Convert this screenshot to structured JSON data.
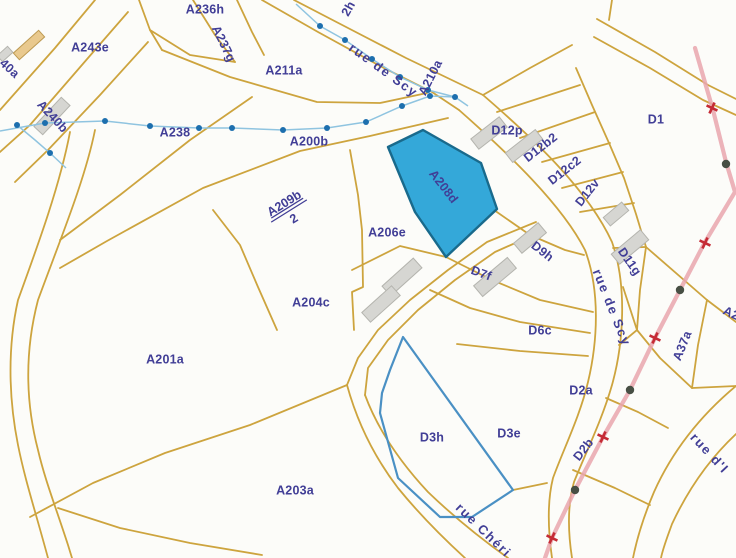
{
  "colors": {
    "background": "#fcfcf9",
    "parcel_line": "#cda43e",
    "label": "#413e96",
    "selected_fill": "#29a3d7",
    "selected_stroke": "#196a8c",
    "outlined_stroke": "#4a90c4",
    "stream_line": "#8fc4e0",
    "stream_dot": "#1d6fae",
    "boundary_line": "#e9a6ae",
    "boundary_cross": "#c52b35",
    "boundary_dot": "#474f44",
    "building_gray": "#d6d6d2",
    "building_gray_stroke": "#b4b4ae",
    "building_tan": "#e9c98e",
    "building_tan_stroke": "#bd9a52"
  },
  "map": {
    "width": 736,
    "height": 558,
    "selected_parcel": {
      "id": "A208d",
      "points": "423,130 481,163 497,209 446,257 415,212 388,147"
    },
    "outlined_parcel": {
      "id": "D3h",
      "points": "403,337 513,490 472,517 440,517 398,478 380,413 382,393 390,370"
    },
    "lines": [
      "M262,0 L318,32 L380,66 L432,92 L459,110",
      "M294,0 L348,28 L406,58 L458,83 L483,95",
      "M459,110 C510,155 562,205 585,250 C600,290 598,340 588,382 C580,416 564,448 553,478 C547,502 548,530 552,558",
      "M483,95 C535,140 588,190 612,242 C627,285 624,342 612,385 C602,420 586,452 574,482 C567,506 568,532 572,558",
      "M347,385 C358,425 375,458 398,488 C420,515 442,537 465,558",
      "M365,395 C378,430 400,462 428,492 C455,518 480,538 508,558",
      "M536,222 L487,242 L448,270 L410,300 L378,330 L358,358 L347,385",
      "M540,232 L495,252 L455,280 L418,310 L388,340 L368,368 L365,395",
      "M736,386 C700,416 672,452 654,492 C643,518 637,538 633,558",
      "M736,434 C706,462 686,494 672,524 C667,538 663,548 661,558",
      "M597,19 L655,52 L708,85 L736,99",
      "M594,37 L650,68 L703,100 L736,115",
      "M612,0 L609,20",
      "M483,95 L530,68 L572,45",
      "M576,68 L592,105 L609,143 L624,178 L636,214 L646,247",
      "M497,112 L580,85",
      "M520,138 L595,112",
      "M542,162 L610,143",
      "M562,188 L623,172",
      "M580,212 L634,203",
      "M613,248 L646,247",
      "M646,247 L707,300",
      "M646,247 L640,290 L637,330",
      "M707,300 L698,345 L692,388",
      "M637,330 L660,358 L692,388",
      "M707,300 L736,322",
      "M623,287 L637,330",
      "M494,210 L530,235 L565,250 L584,255",
      "M446,257 L492,280 L540,300 L593,312",
      "M430,290 L470,308 L520,322 L590,333",
      "M457,344 L520,351 L588,356",
      "M619,345 L637,330",
      "M606,398 L638,412 L668,428",
      "M573,470 L615,488 L650,505",
      "M513,490 L547,483",
      "M347,385 L250,425 L165,453 L93,483 L30,517",
      "M95,130 C85,180 60,240 38,300 C25,350 25,400 38,450 C45,480 55,505 68,545 L72,558",
      "M70,132 C60,185 38,245 18,300 C8,345 8,395 18,445 C25,480 35,510 48,558",
      "M58,508 L120,528 L190,543 L262,555",
      "M95,0 L55,48 L0,110",
      "M128,12 L88,58 L30,125 L0,152",
      "M148,42 L100,95 L48,150 L15,182",
      "M139,0 L150,30 L162,50",
      "M162,50 L230,77 L317,102 L380,103 L427,93",
      "M252,97 L190,140 L120,195 L60,240",
      "M448,118 L370,136 L300,151 L203,188 L107,241 L60,268",
      "M213,210 L240,245 L258,287 L277,330",
      "M350,150 L358,195 L362,230 L363,287 L352,292 L354,330",
      "M352,270 L400,246 L446,257",
      "M193,0 L215,35 L235,62",
      "M237,0 L252,32 L264,55",
      "M150,30 L190,55 L235,62",
      "M692,388 L714,387 L736,386"
    ],
    "buildings": [
      {
        "x": 29,
        "y": 45,
        "w": 34,
        "h": 9,
        "rot": -42,
        "tone": "tan"
      },
      {
        "x": 5,
        "y": 54,
        "w": 14,
        "h": 8,
        "rot": -42,
        "tone": "gray"
      },
      {
        "x": 52,
        "y": 116,
        "w": 40,
        "h": 12,
        "rot": -47,
        "tone": "gray"
      },
      {
        "x": 489,
        "y": 133,
        "w": 36,
        "h": 13,
        "rot": -38,
        "tone": "gray"
      },
      {
        "x": 524,
        "y": 146,
        "w": 38,
        "h": 12,
        "rot": -38,
        "tone": "gray"
      },
      {
        "x": 616,
        "y": 214,
        "w": 24,
        "h": 11,
        "rot": -40,
        "tone": "gray"
      },
      {
        "x": 630,
        "y": 247,
        "w": 38,
        "h": 13,
        "rot": -40,
        "tone": "gray"
      },
      {
        "x": 530,
        "y": 238,
        "w": 32,
        "h": 13,
        "rot": -40,
        "tone": "gray"
      },
      {
        "x": 495,
        "y": 277,
        "w": 44,
        "h": 14,
        "rot": -40,
        "tone": "gray"
      },
      {
        "x": 402,
        "y": 277,
        "w": 42,
        "h": 13,
        "rot": -42,
        "tone": "gray"
      },
      {
        "x": 381,
        "y": 304,
        "w": 40,
        "h": 13,
        "rot": -42,
        "tone": "gray"
      }
    ],
    "stream": {
      "paths": [
        "M0,131 L45,123 L105,121 L150,126 L199,128 L232,128 L283,130 L327,128 L366,122 L402,106 L430,96 L455,97 L468,106",
        "M296,4 L320,26 L345,40 L372,59 L400,77 L428,90 L455,97",
        "M17,125 L35,140 L50,153 L66,168"
      ],
      "dots": [
        [
          17,
          125
        ],
        [
          45,
          123
        ],
        [
          105,
          121
        ],
        [
          150,
          126
        ],
        [
          199,
          128
        ],
        [
          232,
          128
        ],
        [
          283,
          130
        ],
        [
          327,
          128
        ],
        [
          366,
          122
        ],
        [
          402,
          106
        ],
        [
          430,
          96
        ],
        [
          455,
          97
        ],
        [
          320,
          26
        ],
        [
          345,
          40
        ],
        [
          372,
          59
        ],
        [
          400,
          77
        ],
        [
          428,
          90
        ],
        [
          50,
          153
        ]
      ]
    },
    "boundary": {
      "path": "M695,48 L713,110 L726,162 L735,192 L705,242 L680,290 L655,338 L630,390 L603,437 L575,490 L552,538 L545,558",
      "crosses": [
        [
          712,
          108
        ],
        [
          705,
          243
        ],
        [
          655,
          338
        ],
        [
          603,
          437
        ],
        [
          552,
          538
        ]
      ],
      "dots": [
        [
          726,
          164
        ],
        [
          680,
          290
        ],
        [
          630,
          390
        ],
        [
          575,
          490
        ]
      ]
    },
    "labels": [
      {
        "text": "A236h",
        "x": 205,
        "y": 10,
        "rot": 0,
        "kind": "parcel"
      },
      {
        "text": "2h",
        "x": 349,
        "y": 9,
        "rot": -60,
        "kind": "parcel"
      },
      {
        "text": "A243e",
        "x": 90,
        "y": 48,
        "rot": 0,
        "kind": "parcel"
      },
      {
        "text": "A237g",
        "x": 223,
        "y": 44,
        "rot": 64,
        "kind": "parcel"
      },
      {
        "text": "40a",
        "x": 9,
        "y": 69,
        "rot": 42,
        "kind": "parcel"
      },
      {
        "text": "A211a",
        "x": 284,
        "y": 71,
        "rot": 0,
        "kind": "parcel"
      },
      {
        "text": "A210a",
        "x": 431,
        "y": 78,
        "rot": -63,
        "kind": "parcel"
      },
      {
        "text": "A240b",
        "x": 52,
        "y": 117,
        "rot": 47,
        "kind": "parcel"
      },
      {
        "text": "A238",
        "x": 175,
        "y": 133,
        "rot": 0,
        "kind": "parcel"
      },
      {
        "text": "A200b",
        "x": 309,
        "y": 142,
        "rot": 0,
        "kind": "parcel"
      },
      {
        "text": "D12p",
        "x": 507,
        "y": 131,
        "rot": 0,
        "kind": "parcel"
      },
      {
        "text": "D12b2",
        "x": 541,
        "y": 148,
        "rot": -38,
        "kind": "parcel"
      },
      {
        "text": "D12c2",
        "x": 565,
        "y": 171,
        "rot": -38,
        "kind": "parcel"
      },
      {
        "text": "D12v",
        "x": 588,
        "y": 193,
        "rot": -52,
        "kind": "parcel"
      },
      {
        "text": "D1",
        "x": 656,
        "y": 120,
        "rot": 0,
        "kind": "parcel"
      },
      {
        "text": "A209b",
        "denominator": "2",
        "x": 289,
        "y": 211,
        "rot": -32,
        "kind": "fraction"
      },
      {
        "text": "A206e",
        "x": 387,
        "y": 233,
        "rot": 0,
        "kind": "parcel"
      },
      {
        "text": "A208d",
        "x": 443,
        "y": 187,
        "rot": 52,
        "kind": "parcel"
      },
      {
        "text": "D9h",
        "x": 542,
        "y": 252,
        "rot": 38,
        "kind": "parcel"
      },
      {
        "text": "D11g",
        "x": 629,
        "y": 262,
        "rot": 55,
        "kind": "parcel"
      },
      {
        "text": "D7f",
        "x": 481,
        "y": 274,
        "rot": 20,
        "kind": "parcel"
      },
      {
        "text": "A37a",
        "x": 683,
        "y": 346,
        "rot": -68,
        "kind": "parcel"
      },
      {
        "text": "A2",
        "x": 731,
        "y": 314,
        "rot": 25,
        "kind": "parcel"
      },
      {
        "text": "D6c",
        "x": 540,
        "y": 331,
        "rot": 0,
        "kind": "parcel"
      },
      {
        "text": "A204c",
        "x": 311,
        "y": 303,
        "rot": 0,
        "kind": "parcel"
      },
      {
        "text": "A201a",
        "x": 165,
        "y": 360,
        "rot": 0,
        "kind": "parcel"
      },
      {
        "text": "D2a",
        "x": 581,
        "y": 391,
        "rot": 0,
        "kind": "parcel"
      },
      {
        "text": "D3h",
        "x": 432,
        "y": 438,
        "rot": 0,
        "kind": "parcel"
      },
      {
        "text": "D3e",
        "x": 509,
        "y": 434,
        "rot": 0,
        "kind": "parcel"
      },
      {
        "text": "D2b",
        "x": 584,
        "y": 450,
        "rot": -52,
        "kind": "parcel"
      },
      {
        "text": "A203a",
        "x": 295,
        "y": 491,
        "rot": 0,
        "kind": "parcel"
      },
      {
        "text": "rue de Scy",
        "x": 383,
        "y": 71,
        "rot": 36,
        "kind": "street"
      },
      {
        "text": "rue de Scy",
        "x": 611,
        "y": 308,
        "rot": 68,
        "kind": "street"
      },
      {
        "text": "rue Chéri",
        "x": 483,
        "y": 531,
        "rot": 44,
        "kind": "street"
      },
      {
        "text": "rue d'I",
        "x": 709,
        "y": 454,
        "rot": 47,
        "kind": "street"
      }
    ]
  }
}
